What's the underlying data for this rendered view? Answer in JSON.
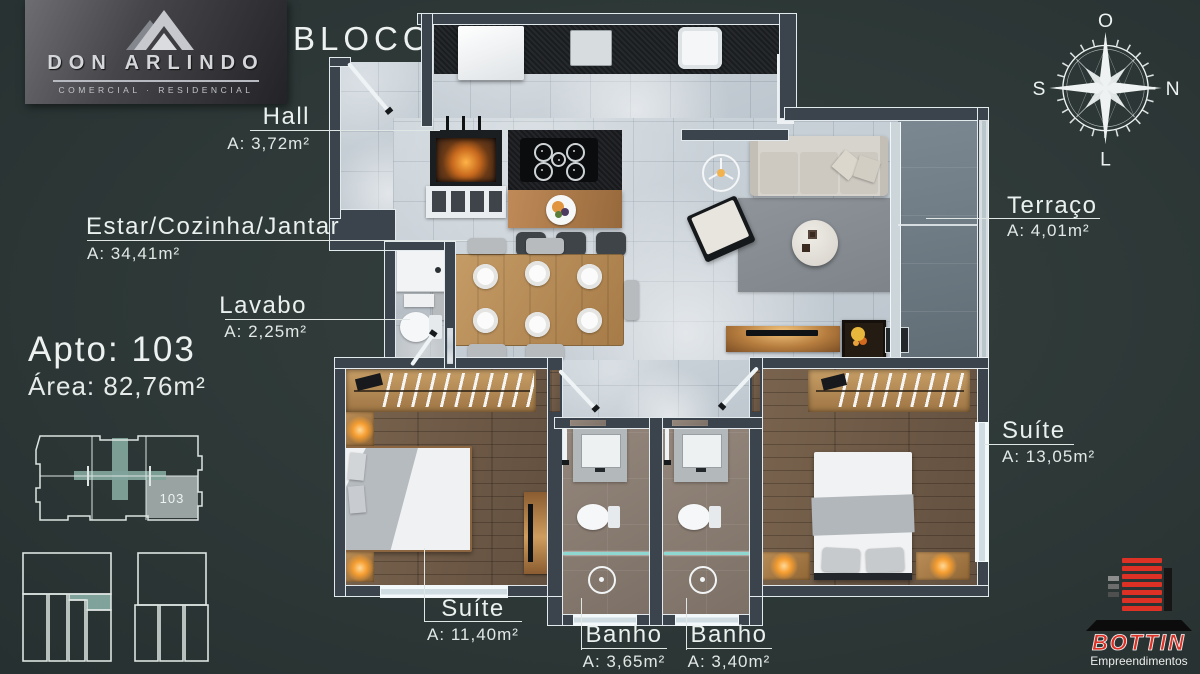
{
  "title": {
    "bloco": "BLOCO B"
  },
  "apartment": {
    "apto": "Apto: 103",
    "area": "Área: 82,76m²",
    "unit": "103"
  },
  "labels": {
    "hall": {
      "name": "Hall",
      "area": "A: 3,72m²"
    },
    "estar": {
      "name": "Estar/Cozinha/Jantar",
      "area": "A: 34,41m²"
    },
    "lavabo": {
      "name": "Lavabo",
      "area": "A: 2,25m²"
    },
    "terraco": {
      "name": "Terraço",
      "area": "A: 4,01m²"
    },
    "suite_right": {
      "name": "Suíte",
      "area": "A: 13,05m²"
    },
    "suite_bottom": {
      "name": "Suíte",
      "area": "A: 11,40m²"
    },
    "banho_left": {
      "name": "Banho",
      "area": "A: 3,65m²"
    },
    "banho_right": {
      "name": "Banho",
      "area": "A: 3,40m²"
    }
  },
  "compass": {
    "top": "O",
    "right": "N",
    "left": "S",
    "bottom": "L"
  },
  "branding": {
    "don_arlindo": {
      "name": "DON ARLINDO",
      "tagline": "COMERCIAL · RESIDENCIAL"
    },
    "bottin": {
      "name": "BOTTIN",
      "tagline": "Empreendimentos"
    }
  },
  "colors": {
    "background": "#2d3837",
    "label_text": "#eaf0ee",
    "keyplan_highlight": "#7fa39a",
    "keyplan_unit_fill": "#98a3a2",
    "bottin_red": "#dd3125"
  }
}
